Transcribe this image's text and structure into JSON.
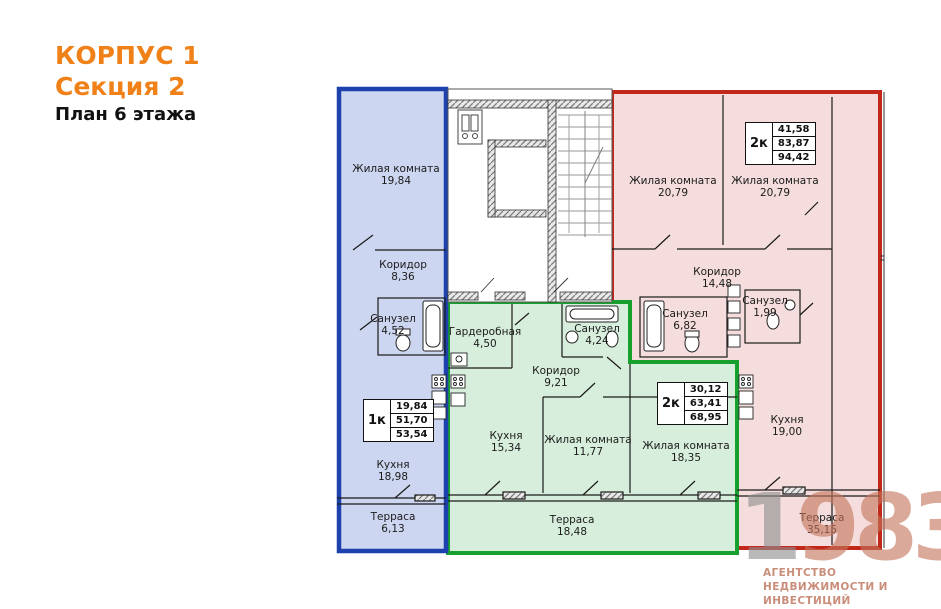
{
  "header": {
    "building": "КОРПУС 1",
    "section": "Секция 2",
    "plan_title": "План 6 этажа",
    "accent_color": "#f08119"
  },
  "apartments": [
    {
      "id": "blue-1k",
      "colors": {
        "border": "#1d41ad",
        "fill": "#cdd6f0"
      },
      "info": {
        "type": "1к",
        "values": [
          "19,84",
          "51,70",
          "53,54"
        ]
      },
      "rooms": [
        {
          "name": "Жилая комната",
          "area": "19,84"
        },
        {
          "name": "Коридор",
          "area": "8,36"
        },
        {
          "name": "Санузел",
          "area": "4,52"
        },
        {
          "name": "Кухня",
          "area": "18,98"
        },
        {
          "name": "Терраса",
          "area": "6,13"
        }
      ]
    },
    {
      "id": "green-2k",
      "colors": {
        "border": "#17a02e",
        "fill": "#d7eedc"
      },
      "info": {
        "type": "2к",
        "values": [
          "30,12",
          "63,41",
          "68,95"
        ]
      },
      "rooms": [
        {
          "name": "Гардеробная",
          "area": "4,50"
        },
        {
          "name": "Санузел",
          "area": "4,24"
        },
        {
          "name": "Коридор",
          "area": "9,21"
        },
        {
          "name": "Кухня",
          "area": "15,34"
        },
        {
          "name": "Жилая комната",
          "area": "11,77"
        },
        {
          "name": "Жилая комната",
          "area": "18,35"
        },
        {
          "name": "Терраса",
          "area": "18,48"
        }
      ]
    },
    {
      "id": "red-2k",
      "colors": {
        "border": "#c2281a",
        "fill": "#f4dddc"
      },
      "info": {
        "type": "2к",
        "values": [
          "41,58",
          "83,87",
          "94,42"
        ]
      },
      "rooms": [
        {
          "name": "Жилая комната",
          "area": "20,79"
        },
        {
          "name": "Жилая комната",
          "area": "20,79"
        },
        {
          "name": "Коридор",
          "area": "14,48"
        },
        {
          "name": "Санузел",
          "area": "6,82"
        },
        {
          "name": "Санузел",
          "area": "1,99"
        },
        {
          "name": "Кухня",
          "area": "19,00"
        },
        {
          "name": "Терраса",
          "area": "35,15"
        }
      ]
    }
  ],
  "logo": {
    "digits": [
      "1",
      "9",
      "8",
      "3"
    ],
    "line1": "АГЕНТСТВО",
    "line2": "НЕДВИЖИМОСТИ И ИНВЕСТИЦИЙ",
    "gray": "#8f8f8f",
    "salmon": "#c98d7a"
  }
}
